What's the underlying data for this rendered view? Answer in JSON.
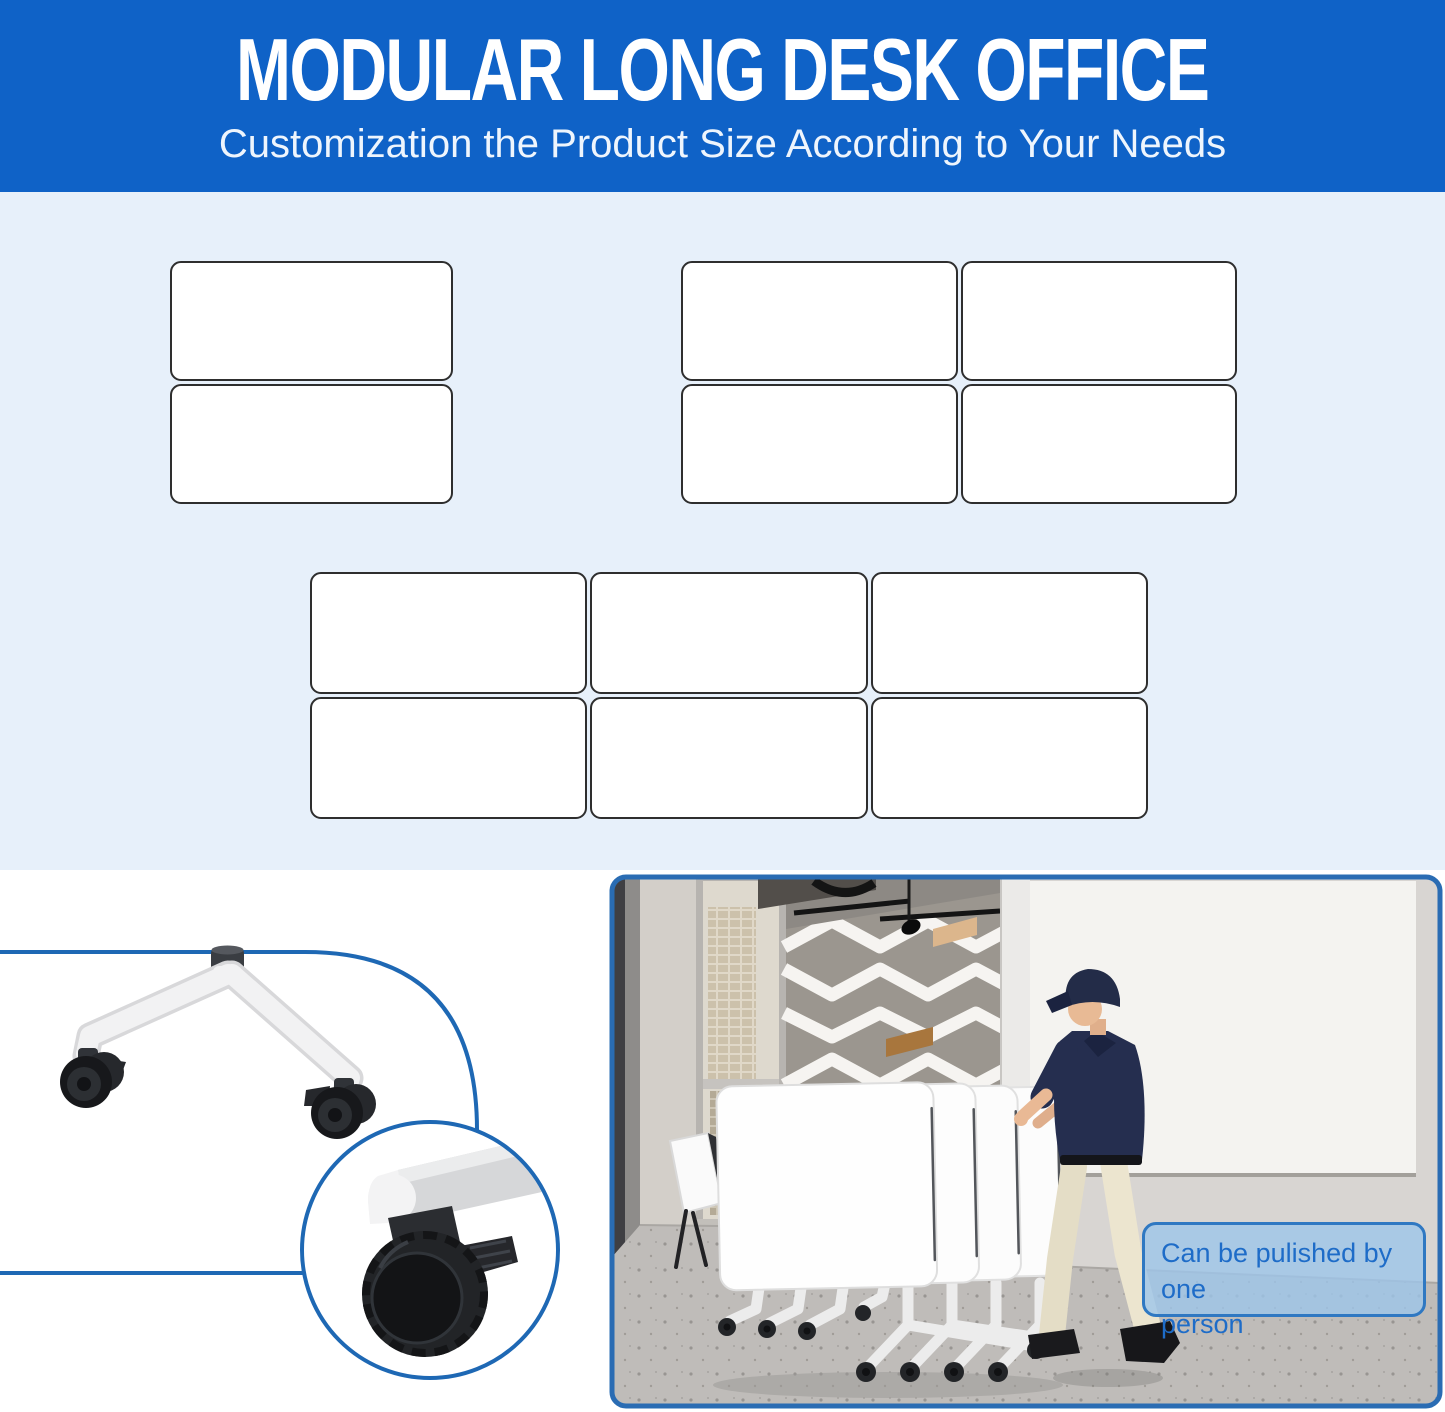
{
  "page": {
    "bg_color": "#ffffff"
  },
  "header": {
    "title": "MODULAR LONG DESK OFFICE",
    "subtitle": "Customization the Product Size According to Your Needs",
    "bg_color": "#0f62c7",
    "title_color": "#ffffff",
    "subtitle_color": "#eef5fd"
  },
  "diagram": {
    "section_bg_color": "#e7f0fa",
    "desk_fill": "#ffffff",
    "desk_border_color": "#2e2e2e",
    "groups": [
      {
        "name": "desk-layout-1x2",
        "cols": 1,
        "rows": 2
      },
      {
        "name": "desk-layout-2x2",
        "cols": 2,
        "rows": 2
      },
      {
        "name": "desk-layout-3x2",
        "cols": 3,
        "rows": 2
      }
    ]
  },
  "detail_callout": {
    "accent_color": "#1e68b4"
  },
  "photo_panel": {
    "border_color": "#2a6cb3",
    "callout": {
      "text": "Can be pulished by one\nperson",
      "text_color": "#1e6cc8",
      "bg_color": "rgba(157,198,234,0.8)",
      "border_color": "#2f78c2"
    }
  }
}
